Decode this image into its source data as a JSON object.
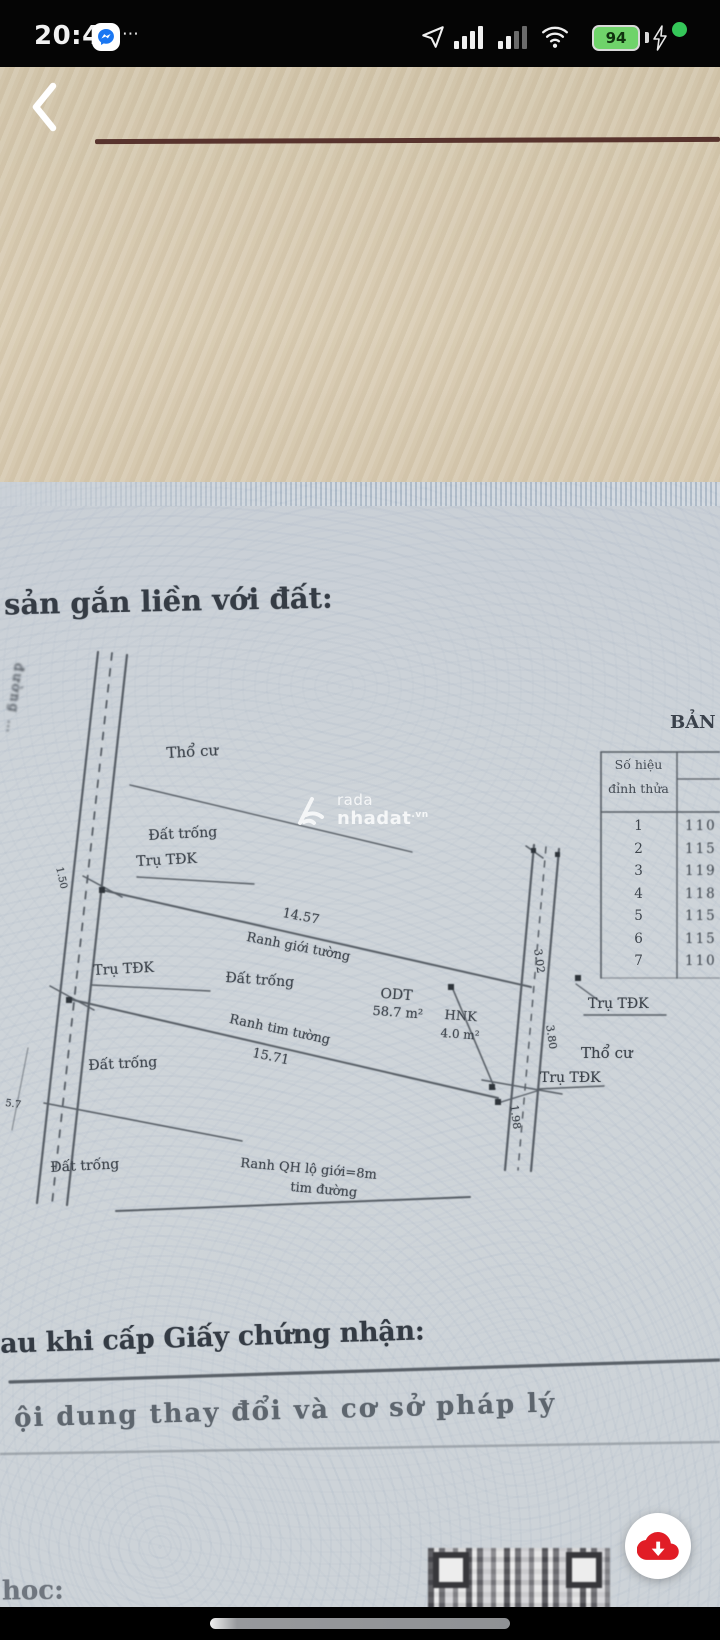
{
  "status_bar": {
    "time": "20:49",
    "more_icon": "⋯",
    "battery_percent": "94"
  },
  "doc": {
    "heading_fragment": "sản gắn liền với đất:",
    "after_grant_heading": "au khi cấp Giấy chứng nhận:",
    "legal_basis_line": "ội dung thay đổi và cơ sở pháp lý",
    "bottom_fragment": "hoc:",
    "watermark": {
      "top": "rada",
      "bottom": "nhadat",
      "suffix": ".vn"
    },
    "table": {
      "title": "BẢN",
      "header_line1": "Số hiệu",
      "header_line2": "đỉnh thửa",
      "rows": [
        {
          "n": "1",
          "v": "110"
        },
        {
          "n": "2",
          "v": "115"
        },
        {
          "n": "3",
          "v": "119"
        },
        {
          "n": "4",
          "v": "118"
        },
        {
          "n": "5",
          "v": "115"
        },
        {
          "n": "6",
          "v": "115"
        },
        {
          "n": "7",
          "v": "110"
        }
      ]
    },
    "map": {
      "labels": [
        {
          "t": "Thổ cư"
        },
        {
          "t": "Đất trống"
        },
        {
          "t": "Trụ TĐK"
        },
        {
          "t": "14.57"
        },
        {
          "t": "Ranh giới tường"
        },
        {
          "t": "Trụ TĐK"
        },
        {
          "t": "Đất trống"
        },
        {
          "t": "ODT"
        },
        {
          "t": "58.7 m²"
        },
        {
          "t": "HNK"
        },
        {
          "t": "4.0 m²"
        },
        {
          "t": "Ranh tim tường"
        },
        {
          "t": "15.71"
        },
        {
          "t": "Đất trống"
        },
        {
          "t": "Trụ TĐK"
        },
        {
          "t": "Thổ cư"
        },
        {
          "t": "Trụ TĐK"
        },
        {
          "t": "Đất trống"
        },
        {
          "t": "Ranh QH lộ giới=8m"
        },
        {
          "t": "tim đường"
        },
        {
          "t": "3.02"
        },
        {
          "t": "3.80"
        },
        {
          "t": "1.98"
        },
        {
          "t": "1.50"
        },
        {
          "t": "đường …"
        },
        {
          "t": "5.7"
        }
      ]
    }
  }
}
